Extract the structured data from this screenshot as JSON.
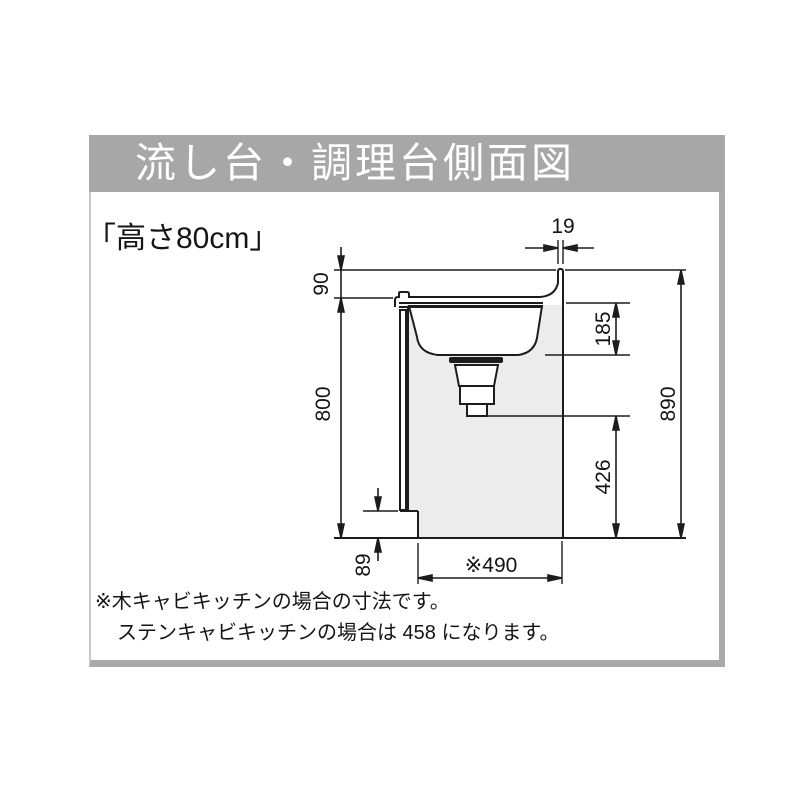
{
  "panel": {
    "title": "流し台・調理台側面図",
    "subtitle": "「高さ80cm」"
  },
  "diagram": {
    "dims": {
      "backsplash_thickness": "19",
      "backsplash_height": "90",
      "counter_height": "800",
      "sink_depth": "185",
      "overall_height": "890",
      "drain_bottom_to_floor": "426",
      "toe_kick_height": "89",
      "cabinet_depth": "※490"
    },
    "colors": {
      "titlebar_gray": "#a7a7a7",
      "cabinet_fill": "#ececec",
      "line": "#1c1c1c"
    }
  },
  "notes": {
    "line1": "※木キャビキッチンの場合の寸法です。",
    "line2": "ステンキャビキッチンの場合は 458 になります。"
  }
}
